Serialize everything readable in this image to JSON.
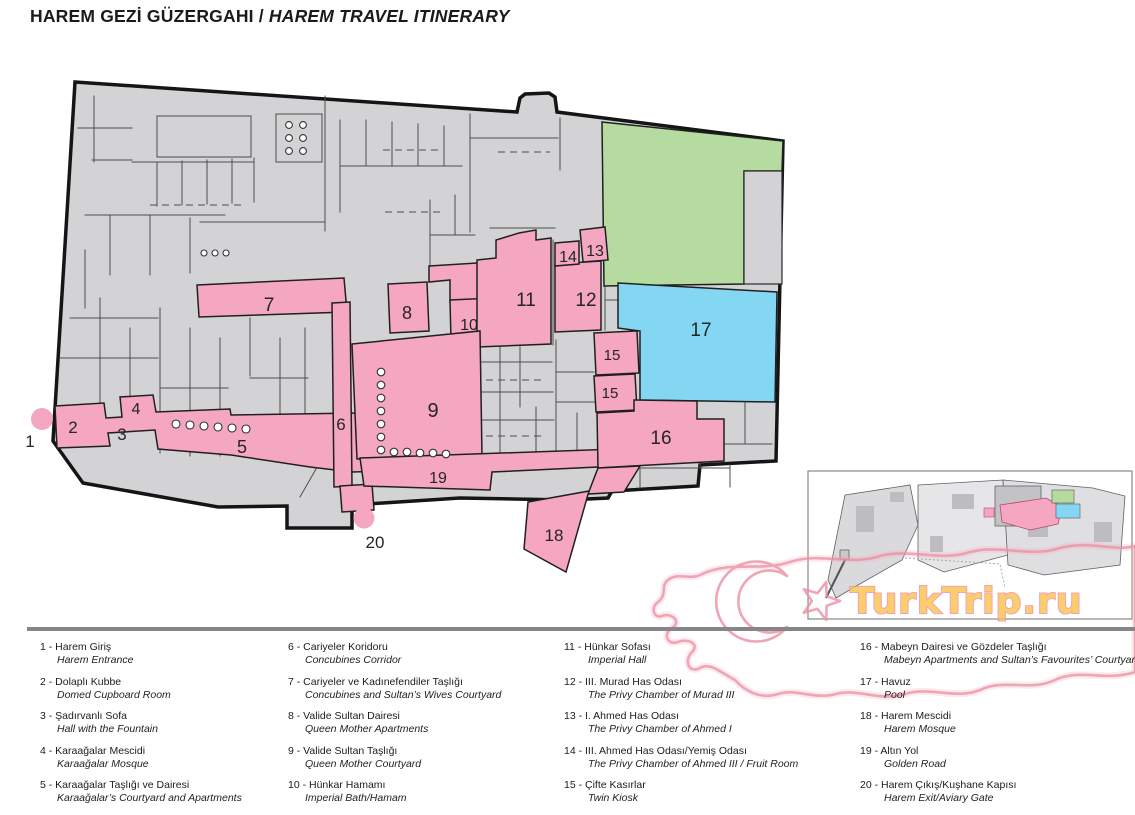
{
  "title": {
    "tr": "HAREM GEZİ GÜZERGAHI",
    "sep": " / ",
    "en": "HAREM TRAVEL ITINERARY"
  },
  "watermark": {
    "text": "TurkTrip.ru"
  },
  "colors": {
    "route_pink": "#F5A6C1",
    "park_green": "#B6DBA1",
    "pool_blue": "#84D7F3",
    "map_gray": "#D3D3D5"
  },
  "map": {
    "area_labels": [
      "1",
      "2",
      "3",
      "4",
      "5",
      "6",
      "7",
      "8",
      "9",
      "10",
      "11",
      "12",
      "13",
      "14",
      "15",
      "16",
      "17",
      "18",
      "19",
      "20"
    ]
  },
  "legend": {
    "columns": [
      {
        "items": [
          {
            "label": "1 - Harem Giriş",
            "en": "Harem Entrance"
          },
          {
            "label": "2 - Dolaplı Kubbe",
            "en": "Domed Cupboard Room"
          },
          {
            "label": "3 - Şadırvanlı Sofa",
            "en": "Hall with the Fountain"
          },
          {
            "label": "4 - Karaağalar Mescidi",
            "en": "Karaağalar Mosque"
          },
          {
            "label": "5 - Karaağalar Taşlığı ve Dairesi",
            "en": "Karaağalar’s Courtyard and Apartments"
          }
        ]
      },
      {
        "items": [
          {
            "label": "6 - Cariyeler Koridoru",
            "en": "Concubines Corridor"
          },
          {
            "label": "7 - Cariyeler ve Kadınefendiler Taşlığı",
            "en": "Concubines and Sultan’s Wives Courtyard"
          },
          {
            "label": "8 - Valide Sultan Dairesi",
            "en": "Queen Mother Apartments"
          },
          {
            "label": "9 - Valide Sultan Taşlığı",
            "en": "Queen Mother Courtyard"
          },
          {
            "label": "10 - Hünkar Hamamı",
            "en": "Imperial Bath/Hamam"
          }
        ]
      },
      {
        "items": [
          {
            "label": "11 - Hünkar Sofası",
            "en": "Imperial Hall"
          },
          {
            "label": "12 - III. Murad Has Odası",
            "en": "The Privy Chamber of Murad III"
          },
          {
            "label": "13 - I. Ahmed Has Odası",
            "en": "The Privy Chamber of Ahmed I"
          },
          {
            "label": "14 - III. Ahmed Has Odası/Yemiş Odası",
            "en": "The Privy Chamber of Ahmed III / Fruit Room"
          },
          {
            "label": "15 - Çifte Kasırlar",
            "en": "Twin Kiosk"
          }
        ]
      },
      {
        "items": [
          {
            "label": "16 - Mabeyn Dairesi ve Gözdeler Taşlığı",
            "en": "Mabeyn Apartments and Sultan’s Favourites’ Courtyard"
          },
          {
            "label": "17 - Havuz",
            "en": "Pool"
          },
          {
            "label": "18 - Harem Mescidi",
            "en": "Harem Mosque"
          },
          {
            "label": "19 - Altın Yol",
            "en": "Golden Road"
          },
          {
            "label": "20 - Harem Çıkış/Kuşhane Kapısı",
            "en": "Harem Exit/Aviary Gate"
          }
        ]
      }
    ]
  }
}
